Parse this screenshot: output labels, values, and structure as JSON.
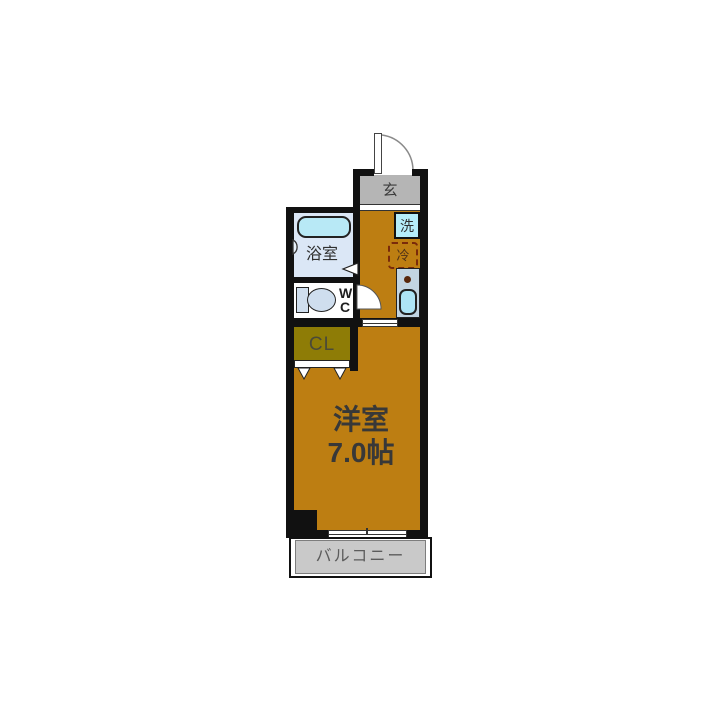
{
  "plan": {
    "type": "apartment-floor-plan",
    "rooms": {
      "entrance": {
        "label": "玄"
      },
      "bathroom": {
        "label": "浴室"
      },
      "toilet": {
        "label_line1": "W",
        "label_line2": "C"
      },
      "closet": {
        "label": "CL"
      },
      "washer": {
        "label": "洗"
      },
      "fridge": {
        "label": "冷"
      },
      "main_room": {
        "label_line1": "洋室",
        "label_line2": "7.0帖"
      },
      "balcony": {
        "label": "バルコニー"
      }
    },
    "icons": {
      "entrance_door": "quarter-arc-door-swing",
      "wc_door": "quarter-disc-door-swing",
      "closet_door": "bi-fold-door-triangles",
      "bath_door": "triangle-opening-marker",
      "window": "sliding-window",
      "shower": "shower-head",
      "stove": "burner-dot"
    },
    "colors": {
      "wall": "#111111",
      "room_fill": "#bd7e12",
      "closet_fill": "#8e7c06",
      "entrance_fill": "#b5b5b5",
      "balcony_fill": "#c9c9c9",
      "bath_floor": "#dbe7f6",
      "tub_fill": "#b8e9f6",
      "fixture_fill": "#cfdeee",
      "counter_fill": "#c2d5e2",
      "sink_fill": "#ade4f5",
      "washer_fill": "#b6edf9",
      "fridge_border": "#7a2a0a"
    }
  }
}
